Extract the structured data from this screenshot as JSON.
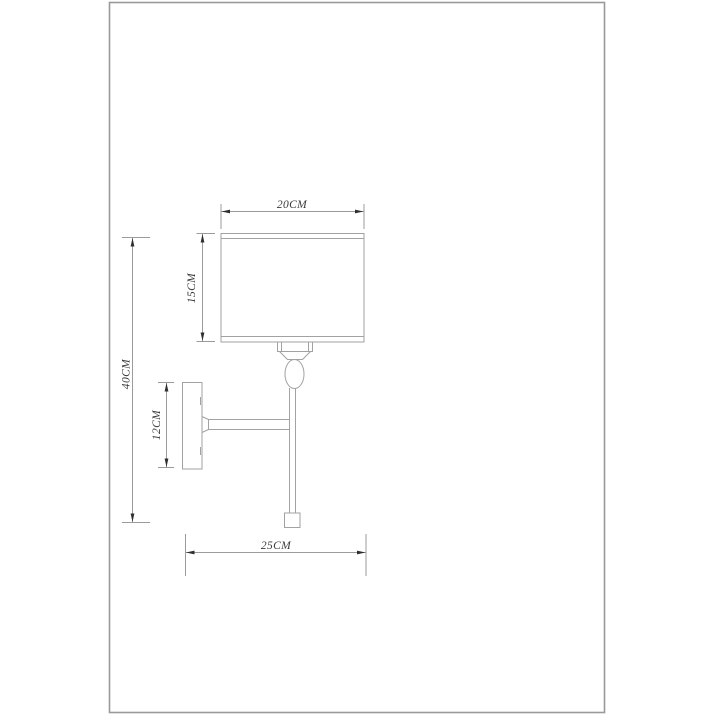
{
  "drawing": {
    "kind": "technical-dimension-drawing",
    "subject": "wall-sconce-lamp-side-view"
  },
  "dimensions": {
    "shade_width": "20CM",
    "shade_height": "15CM",
    "overall_height": "40CM",
    "backplate_height": "12CM",
    "overall_depth": "25CM"
  },
  "colors": {
    "background": "#ffffff",
    "frame_border": "#9a9a9a",
    "object_line": "#a2a2a2",
    "dimension_line": "#9b9b9b",
    "arrow": "#2f2f2f",
    "text": "#3a3a3a"
  }
}
